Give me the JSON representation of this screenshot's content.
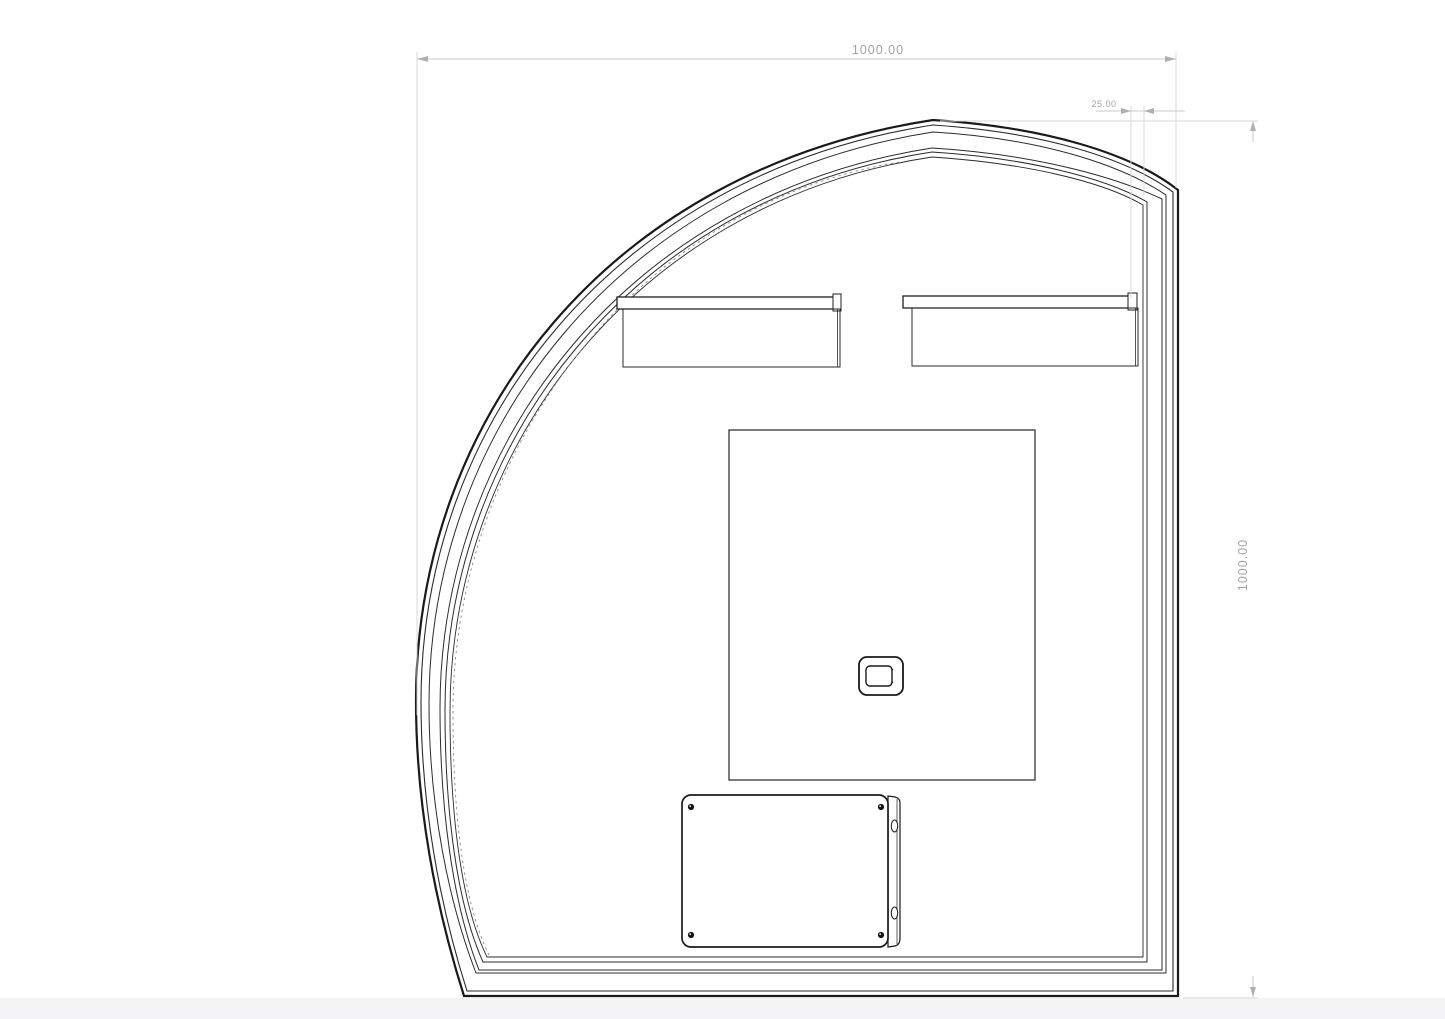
{
  "drawing": {
    "type": "cad-technical-drawing",
    "dimensions": {
      "top_width": "1000.00",
      "right_height": "1000.00",
      "wall_thickness": "25.00"
    },
    "colors": {
      "line": "#1a1a1a",
      "dimension_text": "#a3a3a3",
      "dimension_line": "#c8c8c8",
      "background": "#ffffff",
      "footer_strip": "#f4f4f6"
    }
  }
}
